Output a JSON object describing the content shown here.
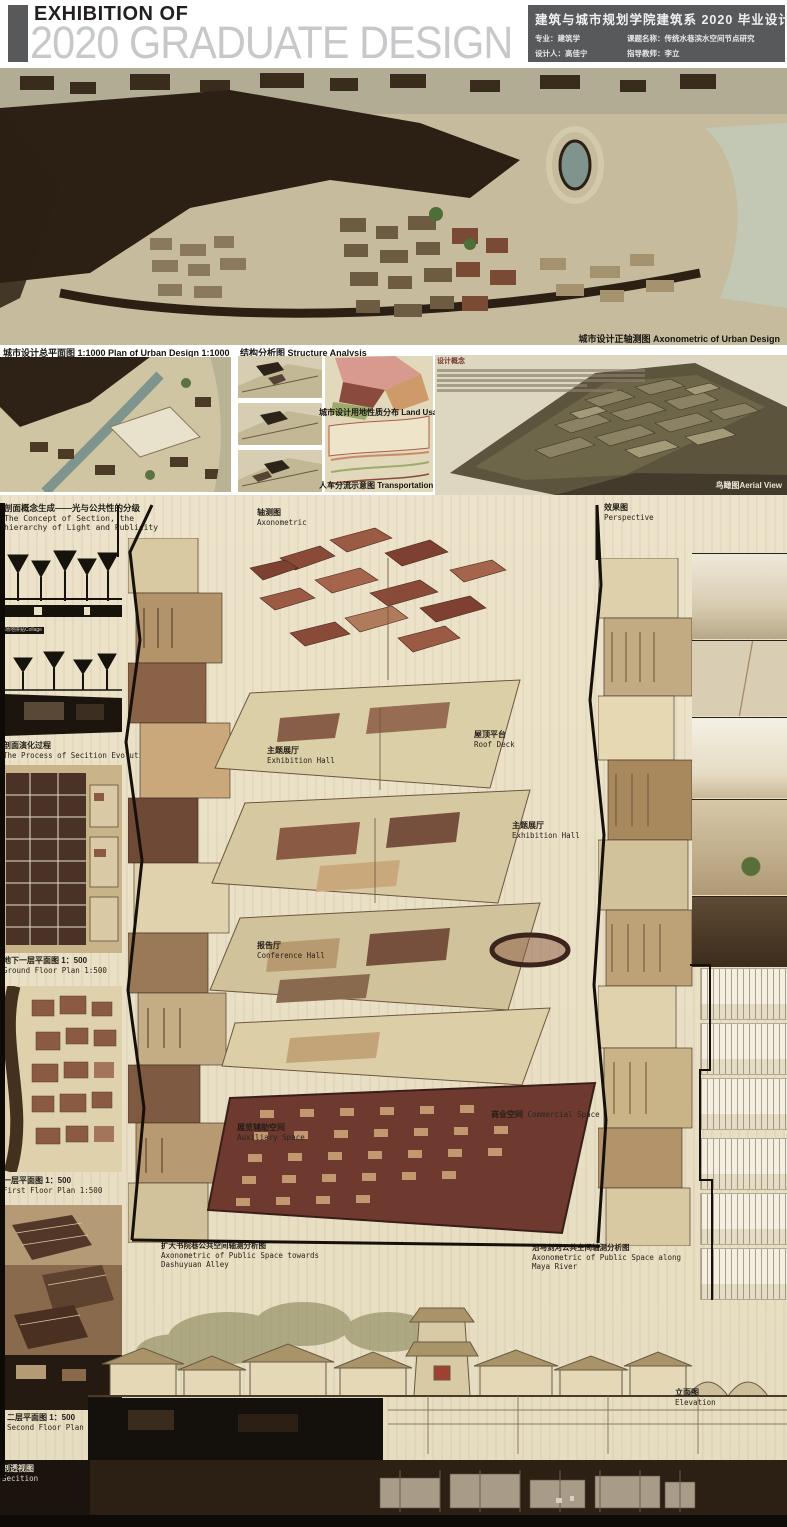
{
  "header": {
    "eyebrow": "EXHIBITION OF",
    "title": "2020 GRADUATE DESIGN",
    "info": {
      "title": "建筑与城市规划学院建筑系 2020 毕业设计展",
      "major": "专业：建筑学",
      "topic": "课题名称：传统水巷滨水空间节点研究",
      "designer": "设计人：高佳宁",
      "advisor": "指导教师：李立"
    }
  },
  "urban": {
    "axon_caption": "城市设计正轴测图 Axonometric of Urban Design",
    "plan_caption": "城市设计总平面图 1:1000 Plan of Urban Design 1:1000",
    "structure_caption": "结构分析图 Structure Analysis",
    "landuse_caption": "城市设计用地性质分布 Land Usage",
    "transport_caption": "人车分流示意图 Transportation Analysis",
    "concept_heading": "设计概念",
    "aerial_caption": "鸟瞰图Aerial View"
  },
  "main": {
    "section_concept_zh": "剖面概念生成——光与公共性的分级",
    "section_concept_en1": "The Concept of Section, the",
    "section_concept_en2": "hierarchy of Light and Publicity",
    "collage_caption": "场地拼贴Collage",
    "evolution_zh": "剖面演化过程",
    "evolution_en": "The Process of Secition Evolution",
    "axon_zh": "轴测图",
    "axon_en": "Axonometric",
    "perspective_zh": "效果图",
    "perspective_en": "Perspective",
    "axon_labels": [
      {
        "zh": "主题展厅",
        "en": "Exhibition Hall"
      },
      {
        "zh": "屋顶平台",
        "en": "Roof Deck"
      },
      {
        "zh": "主题展厅",
        "en": "Exhibition Hall"
      },
      {
        "zh": "报告厅",
        "en": "Conference Hall"
      },
      {
        "zh": "商业空间",
        "en": "Commercial Space"
      },
      {
        "zh": "展览辅助空间",
        "en": "Auxiliary Space"
      }
    ],
    "plan_b1_zh": "地下一层平面图 1：500",
    "plan_b1_en": "Ground Floor Plan 1:500",
    "plan_f1_zh": "一层平面图 1：500",
    "plan_f1_en": "First Floor Plan 1:500",
    "plan_f2_zh": "二层平面图 1：500",
    "plan_f2_en": "Second Floor Plan 1:500",
    "axon_left_zh": "扩大书院巷公共空间轴测分析图",
    "axon_left_en1": "Axonometric of Public Space towards",
    "axon_left_en2": "Dashuyuan Alley",
    "axon_right_zh": "沿马剑河公共空间轴测分析图",
    "axon_right_en1": "Axonometric of Public Space along",
    "axon_right_en2": "Maya River",
    "elevation_zh": "立面图",
    "elevation_en": "Elevation",
    "section_persp_zh": "剖透视图",
    "section_persp_en": "Secition"
  },
  "colors": {
    "header_gray": "#58595b",
    "title_gray": "#c7c8ca",
    "parchment": "#ece3ca",
    "dark_brown": "#2c2014",
    "axon_maroon": "#6e3a30",
    "aerial_olive": "#5c543c",
    "pond_teal": "#7e948c"
  }
}
